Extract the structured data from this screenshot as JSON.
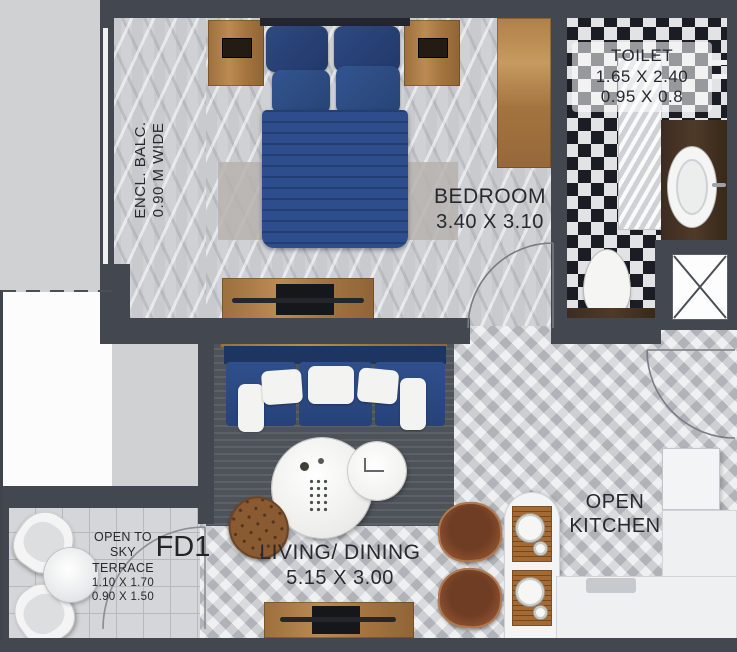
{
  "rooms": {
    "balcony": {
      "line1": "ENCL. BALC.",
      "line2": "0.90 M WIDE"
    },
    "bedroom": {
      "name": "BEDROOM",
      "dims": "3.40 X 3.10"
    },
    "toilet": {
      "name": "TOILET",
      "dims1": "1.65 X 2.40",
      "dims2": "0.95 X 0.8"
    },
    "living": {
      "name": "LIVING/ DINING",
      "dims": "5.15 X 3.00"
    },
    "kitchen": {
      "line1": "OPEN",
      "line2": "KITCHEN"
    },
    "terrace": {
      "line1": "OPEN TO",
      "line2": "SKY",
      "line3": "TERRACE",
      "dims1": "1.10 X 1.70",
      "dims2": "0.90 X 1.50"
    }
  },
  "labels": {
    "terrace_door": "FD1"
  },
  "colors": {
    "wall": "#43474f",
    "floor": "#cfd1d4",
    "bed_blue": "#2e4d8d",
    "sofa_blue": "#2c4b86",
    "wood": "#a97a45",
    "dark_wood": "#402f23",
    "rug": "#4e535a",
    "checker_dark": "#1b1d24",
    "counter_white": "#eef0f1"
  }
}
